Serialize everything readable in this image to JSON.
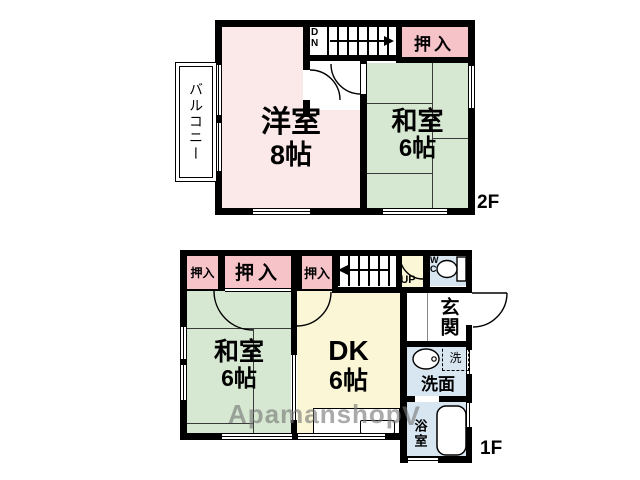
{
  "watermark": {
    "text": "Apamanshop",
    "mark": "V"
  },
  "floor2": {
    "label": "2F",
    "balcony": "バルコニー",
    "stairs_label": "DN",
    "closet": "押入",
    "western_room": {
      "name": "洋室",
      "size": "8帖"
    },
    "tatami_room": {
      "name": "和室",
      "size": "6帖"
    }
  },
  "floor1": {
    "label": "1F",
    "closet_small": "押入",
    "closet_wide": "押入",
    "closet_third": "押入",
    "stairs_label": "UP",
    "toilet": "WC",
    "entrance": "玄関",
    "washroom": "洗面",
    "laundry": "洗",
    "bathroom": "浴室",
    "tatami_room": {
      "name": "和室",
      "size": "6帖"
    },
    "dining_kitchen": {
      "name": "DK",
      "size": "6帖"
    }
  },
  "colors": {
    "wall": "#000000",
    "western_room": "#fbe8e8",
    "tatami_room": "#d6e8d1",
    "closet": "#f6c3c9",
    "dining_kitchen": "#faf6d6",
    "wet_area": "#d8e6f2",
    "watermark": "#777777"
  }
}
